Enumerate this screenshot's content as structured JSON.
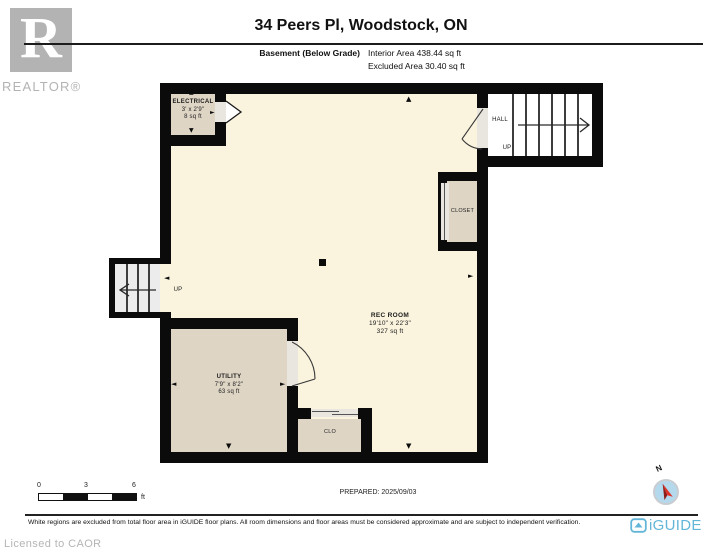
{
  "header": {
    "realtor_logo_letter": "R",
    "realtor_wordmark": "REALTOR®",
    "title": "34 Peers Pl, Woodstock, ON",
    "floor_label": "Basement (Below Grade)",
    "interior_area": "Interior Area 438.44 sq ft",
    "excluded_area": "Excluded Area 30.40 sq ft"
  },
  "floorplan": {
    "rooms": {
      "electrical": {
        "name": "ELECTRICAL",
        "dims": "3' x 2'9\"",
        "area": "8 sq ft"
      },
      "hall": {
        "name": "HALL",
        "stair_label": "UP"
      },
      "closet": {
        "name": "CLOSET"
      },
      "rec_room": {
        "name": "REC ROOM",
        "dims": "19'10\" x 22'3\"",
        "area": "327 sq ft"
      },
      "utility": {
        "name": "UTILITY",
        "dims": "7'9\" x 8'2\"",
        "area": "63 sq ft"
      },
      "clo": {
        "name": "CLO"
      },
      "stairs_left": {
        "stair_label": "UP"
      }
    },
    "glyphs": {
      "arrow_up": "▲",
      "arrow_down": "▼",
      "arrow_left": "◄",
      "arrow_right": "►"
    }
  },
  "footer": {
    "scale": {
      "t0": "0",
      "t3": "3",
      "t6": "6",
      "unit": "ft"
    },
    "prepared": "PREPARED: 2025/09/03",
    "disclaimer": "White regions are excluded from total floor area in iGUIDE floor plans. All room dimensions and floor areas must be considered approximate and are subject to independent verification.",
    "licensed": "Licensed to CAOR",
    "brand": "iGUIDE"
  },
  "compass": {
    "north": "N"
  },
  "colors": {
    "floor_cream": "#faf4de",
    "room_tan": "#ded5c5",
    "wall": "#0b0b0b",
    "brand_blue": "#64b6d9",
    "compass_red": "#e03127",
    "logo_gray": "#b3b3b3"
  }
}
